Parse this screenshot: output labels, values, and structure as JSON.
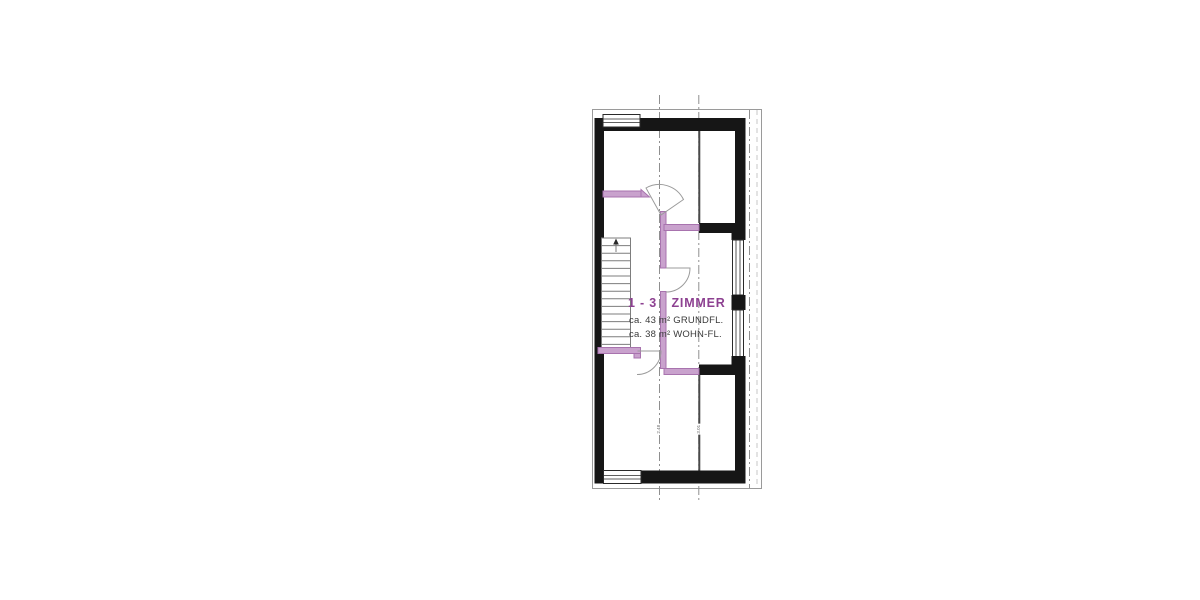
{
  "plan": {
    "unit_label": {
      "range": "1 - 3",
      "name": "ZIMMER"
    },
    "areas": {
      "grundflaeche": "ca. 43 m² GRUNDFL.",
      "wohnflaeche": "ca. 38 m² WOHN-FL."
    },
    "dimension_marks": [
      "2.48",
      "3.01"
    ],
    "colors": {
      "wall_black": "#161616",
      "unit_highlight_purple": "#c9a2cd",
      "unit_highlight_edge": "#a873ae",
      "label_purple": "#8d4191",
      "area_text_gray": "#3a3a3a",
      "drawing_line_gray": "#9a9a9a"
    }
  }
}
